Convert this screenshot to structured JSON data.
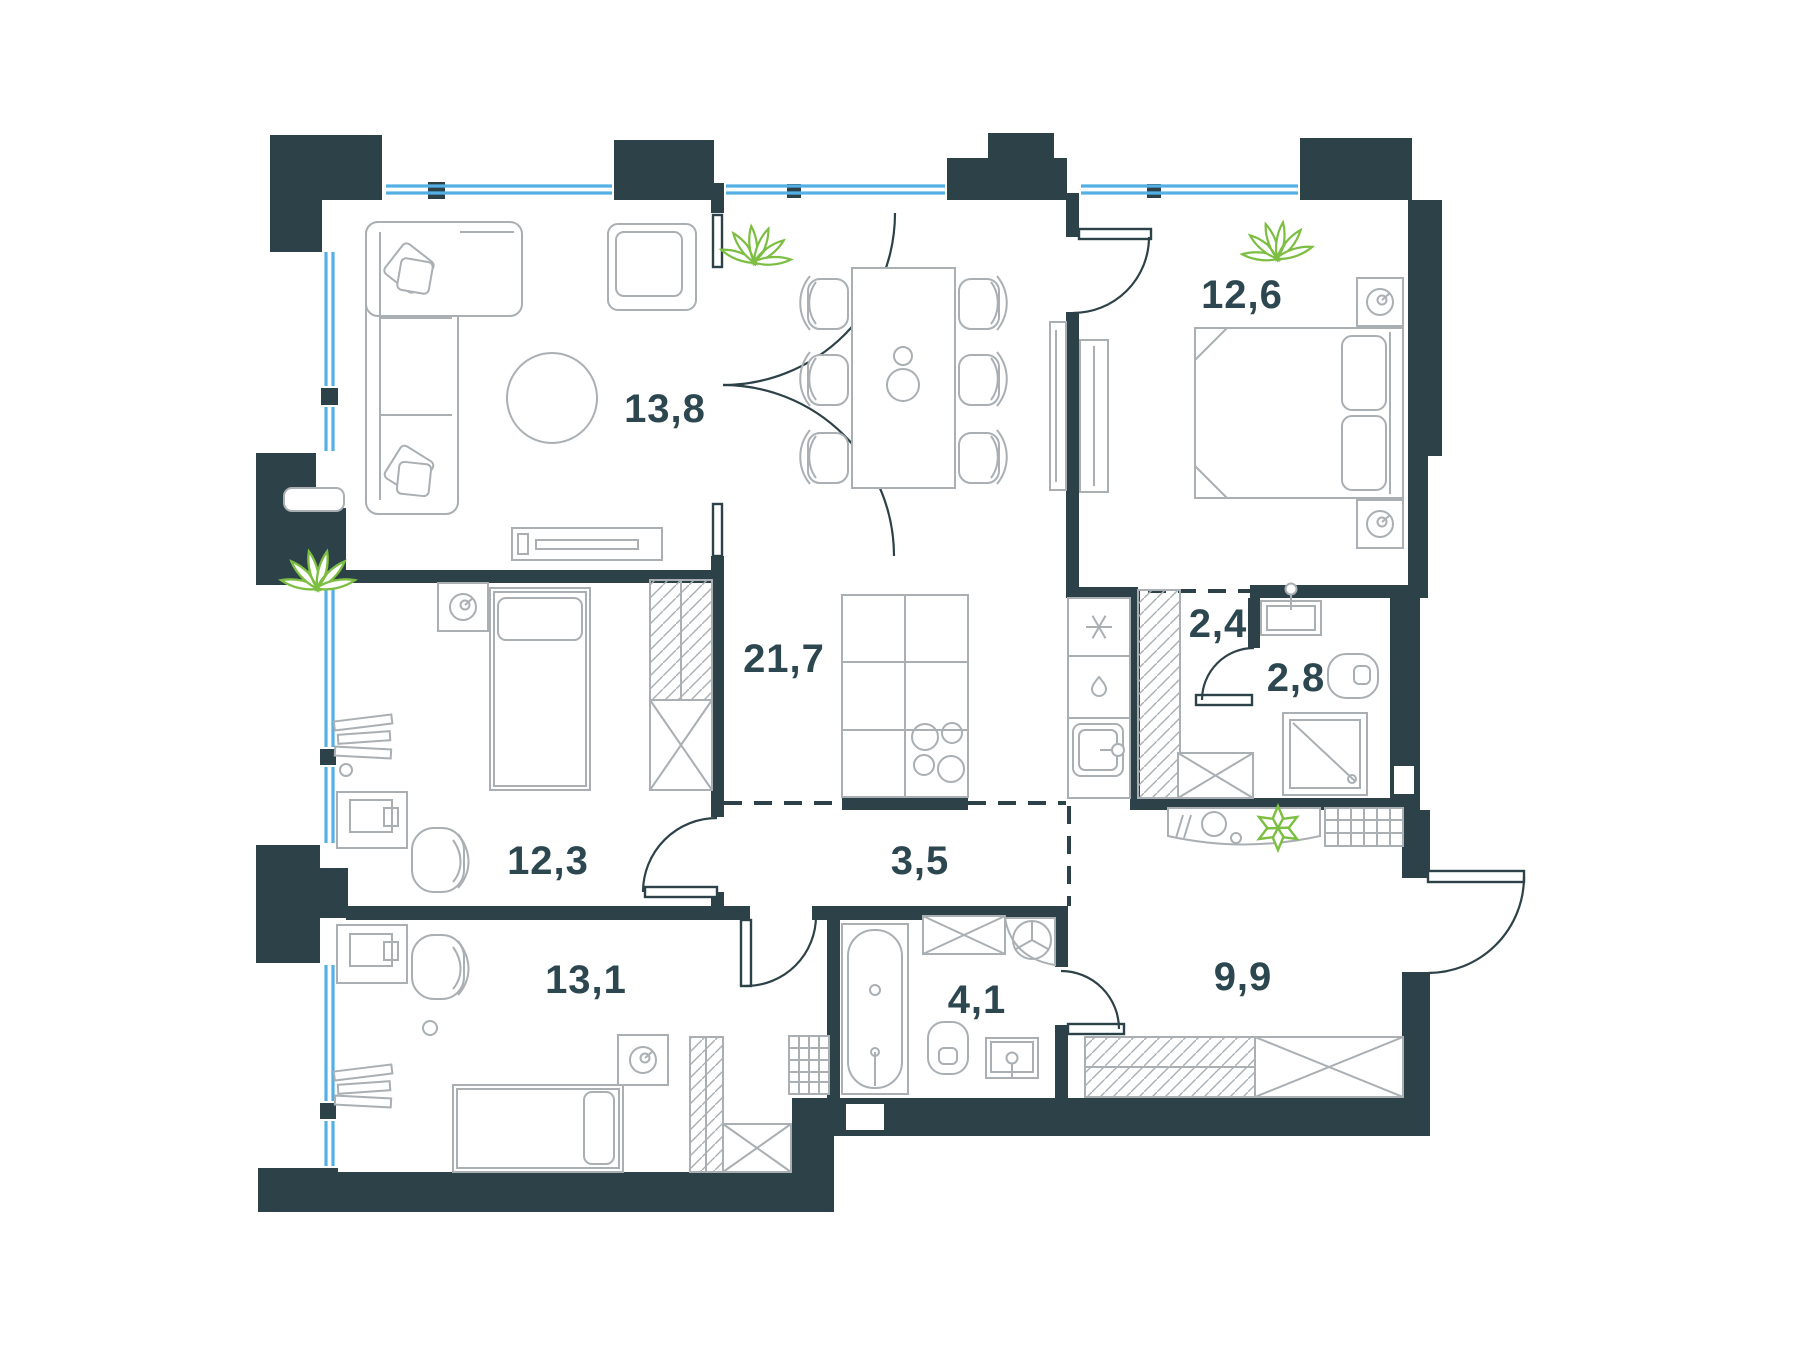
{
  "plan": {
    "type": "apartment-floor-plan",
    "rooms": [
      {
        "id": "living-room",
        "label": "13,8"
      },
      {
        "id": "kitchen-dining",
        "label": "21,7"
      },
      {
        "id": "bedroom-master",
        "label": "12,6"
      },
      {
        "id": "wardrobe-corridor",
        "label": "2,4"
      },
      {
        "id": "bathroom-small",
        "label": "2,8"
      },
      {
        "id": "bedroom-middle",
        "label": "12,3"
      },
      {
        "id": "hallway",
        "label": "3,5"
      },
      {
        "id": "bedroom-bottom",
        "label": "13,1"
      },
      {
        "id": "bathroom-main",
        "label": "4,1"
      },
      {
        "id": "entrance-hall",
        "label": "9,9"
      }
    ],
    "colors": {
      "wall": "#2C4148",
      "window": "#54B0E4",
      "furniture": "#A9AFB3",
      "label": "#2C4750",
      "plant": "#7CBE41",
      "background": "#FFFFFF"
    },
    "icons": [
      "plant-icon",
      "star-plant-icon",
      "snowflake-icon",
      "water-drop-icon",
      "clock-icon",
      "lamp-icon",
      "stove-burners-icon",
      "faucet-icon"
    ]
  }
}
